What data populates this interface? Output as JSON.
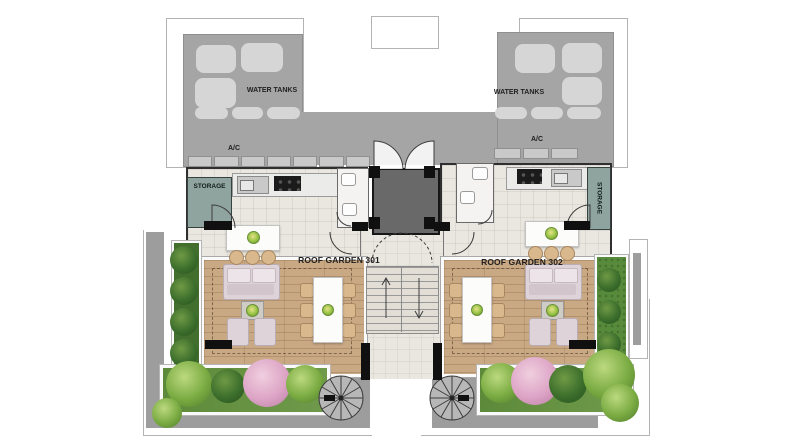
{
  "roof": {
    "left_wing": {
      "water_tanks_label": "WATER TANKS",
      "ac_label": "A/C",
      "tank_count": 3,
      "tank_pill_count": 3,
      "ac_unit_count": 7
    },
    "right_wing": {
      "water_tanks_label": "WATER TANKS",
      "ac_label": "A/C",
      "tank_count": 3,
      "tank_pill_count": 3,
      "ac_unit_count": 3
    }
  },
  "units": [
    {
      "number": "301",
      "name_label": "ROOF GARDEN 301",
      "storage_label": "STORAGE"
    },
    {
      "number": "302",
      "name_label": "ROOF GARDEN 302",
      "storage_label": "STORAGE"
    }
  ],
  "icons": {
    "spiral-staircase": "circle with radial spokes",
    "stairs-up-arrow": "↑",
    "stairs-down-arrow": "↓",
    "door-swing": "quarter-circle arc",
    "plant": "green radial-gradient circle",
    "water-tank": "rounded light-gray rectangle"
  },
  "colors": {
    "roof_gray": "#a5a5a5",
    "tank_fill": "#d6d6d6",
    "ac_fill": "#c9c9c9",
    "tile_floor": "#eae7e0",
    "storage_teal": "#8fa49f",
    "elevator_gray": "#696969",
    "wall_black": "#101010",
    "deck_wood": "#c9a884",
    "stair_fill": "#e2ded6",
    "walkway_gray": "#9d9d9d",
    "hedge_green": "#426f2e",
    "grass_green": "#578a3a",
    "planter_green": "#6f9a4b",
    "plant_light_green": "#9cc25e",
    "plant_dark_green": "#33682b",
    "plant_pink": "#dfaccb",
    "furniture_pink": "#ddd3d8",
    "wood_chair": "#d9b88d",
    "outline_gray": "#b3b3b3",
    "white_parapet": "#fafafa"
  }
}
